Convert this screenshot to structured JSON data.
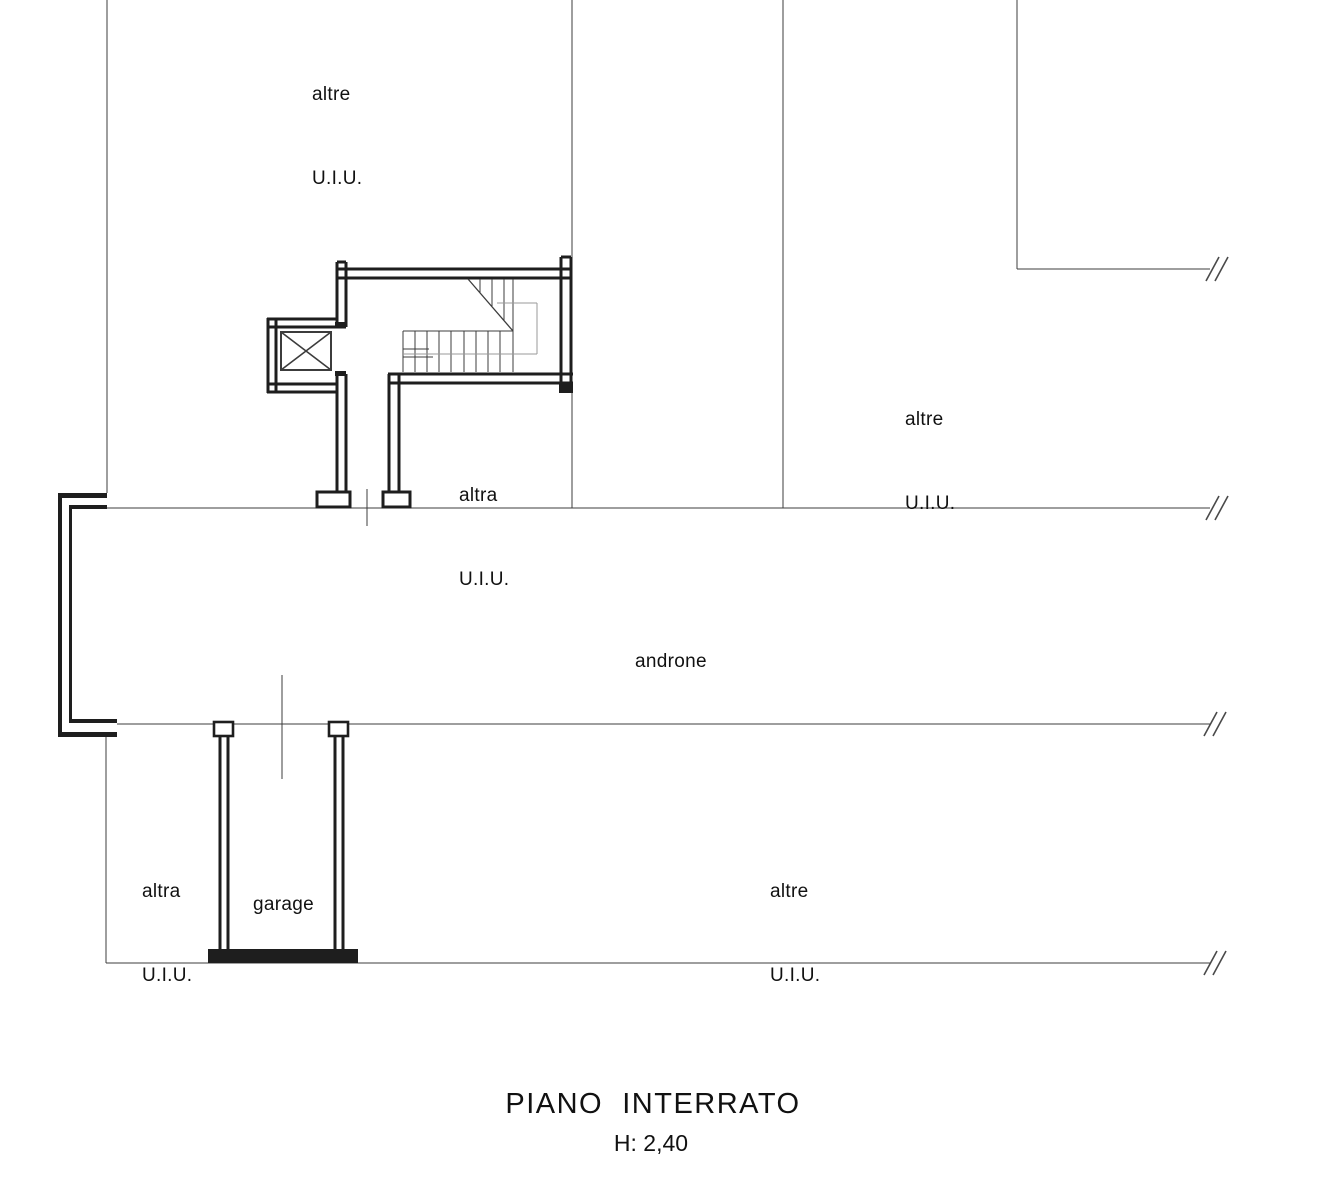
{
  "labels": {
    "top_left_room": {
      "line1": "altre",
      "line2": "U.I.U."
    },
    "top_right_room": {
      "line1": "altre",
      "line2": "U.I.U."
    },
    "stairwell_room": {
      "line1": "altra",
      "line2": "U.I.U."
    },
    "hall": {
      "text": "androne"
    },
    "bottom_left_room": {
      "line1": "altra",
      "line2": "U.I.U."
    },
    "garage": {
      "text": "garage"
    },
    "bottom_right_room": {
      "line1": "altre",
      "line2": "U.I.U."
    }
  },
  "title": {
    "text": "PIANO  INTERRATO",
    "height_label": "H: 2,40"
  },
  "icons": {
    "elevator": "elevator-x-symbol",
    "stairs": "staircase-symbol",
    "line_break": "section-break-hatch"
  },
  "colors": {
    "background": "#ffffff",
    "wall": "#1e1e1e",
    "thin_line": "#3c3c3c",
    "gray_line": "#9a9a9a",
    "hatch": "#4a4a4a",
    "text": "#111111"
  }
}
